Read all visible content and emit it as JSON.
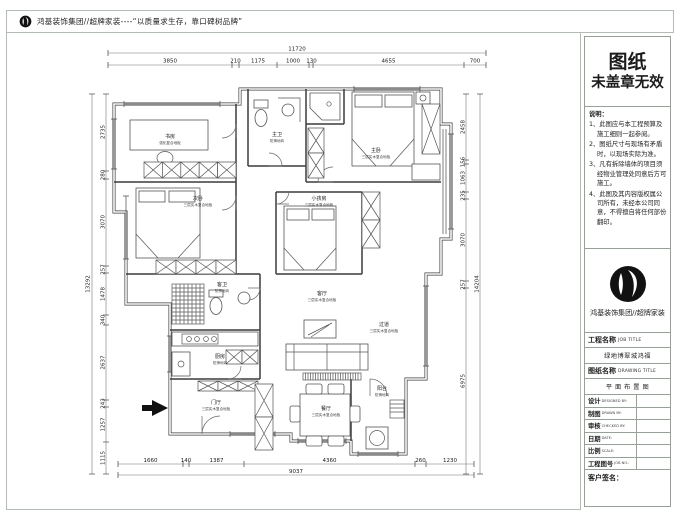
{
  "header": {
    "slogan": "鸿基装饰集团//超牌家装----“以质量求生存，靠口碑树品牌”"
  },
  "titleblock": {
    "stamp_line1": "图纸",
    "stamp_line2": "未盖章无效",
    "notes_title": "说明：",
    "notes": [
      "1、此图应与本工程预算及施工细则一起参阅。",
      "2、图纸尺寸与现场有矛盾时，以现场实际为准。",
      "3、凡有拆除墙体的项目须经物业管理处同意后方可施工。",
      "4、此图及其内容版权属公司所有，未经本公司同意，不得擅自将任何部份翻印。"
    ],
    "company": "鸿基装饰集团//超牌家装",
    "job_label": "工程名称",
    "job_label_en": "JOB TITLE",
    "job_value": "绿地博翠城鸿福",
    "drawing_label": "图纸名称",
    "drawing_label_en": "DRAWING TITLE",
    "drawing_value": "平 面 布 置 图",
    "rows": [
      {
        "label": "设计",
        "en": "DESIGNED BY:"
      },
      {
        "label": "制图",
        "en": "DRAWN BY:"
      },
      {
        "label": "审核",
        "en": "CHECKED BY:"
      },
      {
        "label": "日期",
        "en": "DATE:"
      },
      {
        "label": "比例",
        "en": "SCALE:"
      },
      {
        "label": "工程图号",
        "en": "JOB NO.:"
      }
    ],
    "signature_label": "客户签名："
  },
  "plan": {
    "dims_top": {
      "overall": "11720",
      "segments": [
        "3850",
        "210",
        "1175",
        "1000",
        "130",
        "4655",
        "700"
      ]
    },
    "dims_left": {
      "overall": "13292",
      "segments": [
        "2735",
        "280",
        "3070",
        "257",
        "1478",
        "340",
        "2637",
        "243",
        "1257",
        "1115"
      ]
    },
    "dims_right": {
      "overall": "14204",
      "segments": [
        "2458",
        "156",
        "1063",
        "235",
        "3070",
        "257",
        "6975"
      ]
    },
    "dims_bottom": {
      "overall": "9037",
      "segments": [
        "1660",
        "140",
        "1387",
        "4360",
        "260",
        "1230"
      ]
    },
    "rooms": [
      {
        "name": "书房",
        "floor": "强化复合地板"
      },
      {
        "name": "主卫",
        "floor": "防滑地砖"
      },
      {
        "name": "主卧",
        "floor": "三层实木复合地板"
      },
      {
        "name": "次卧",
        "floor": "三层实木复合地板"
      },
      {
        "name": "小孩房",
        "floor": "三层实木复合地板"
      },
      {
        "name": "客卫",
        "floor": "防滑地砖"
      },
      {
        "name": "厨房",
        "floor": "防滑地砖"
      },
      {
        "name": "客厅",
        "floor": "三层实木复合地板"
      },
      {
        "name": "过道",
        "floor": "三层实木复合地板"
      },
      {
        "name": "餐厅",
        "floor": "三层实木复合地板"
      },
      {
        "name": "门厅",
        "floor": "三层实木复合地板"
      },
      {
        "name": "阳台",
        "floor": "防滑地砖"
      }
    ]
  }
}
